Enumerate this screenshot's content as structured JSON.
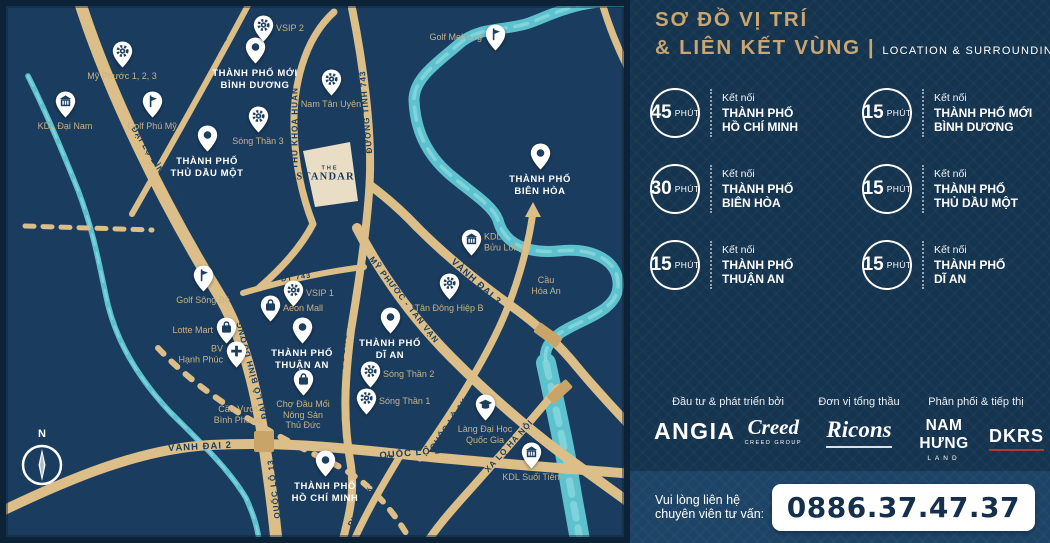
{
  "map": {
    "project": {
      "name_top": "THE",
      "name": "STANDARD"
    },
    "compass_label": "N",
    "cities": [
      {
        "label": "THÀNH PHỐ MỚI\nBÌNH DƯƠNG",
        "x": 255,
        "y": 64
      },
      {
        "label": "THÀNH PHỐ\nTHỦ DẦU MỘT",
        "x": 207,
        "y": 152
      },
      {
        "label": "THÀNH PHỐ\nBIÊN HÒA",
        "x": 540,
        "y": 170
      },
      {
        "label": "THÀNH PHỐ\nTHUẬN AN",
        "x": 302,
        "y": 344
      },
      {
        "label": "THÀNH PHỐ\nDĨ AN",
        "x": 390,
        "y": 334
      },
      {
        "label": "THÀNH PHỐ\nHỒ CHÍ MINH",
        "x": 325,
        "y": 477
      }
    ],
    "pois": [
      {
        "label": "Mỹ Phước 1, 2, 3",
        "icon": "gear",
        "x": 122,
        "y": 68,
        "pos": "below"
      },
      {
        "label": "VSIP 2",
        "icon": "gear",
        "x": 263,
        "y": 42,
        "pos": "right"
      },
      {
        "label": "KDL Đại Nam",
        "icon": "building",
        "x": 65,
        "y": 118,
        "pos": "below"
      },
      {
        "label": "Golf Phú Mỹ",
        "icon": "flag",
        "x": 152,
        "y": 118,
        "pos": "below"
      },
      {
        "label": "Sóng Thần 3",
        "icon": "gear",
        "x": 258,
        "y": 133,
        "pos": "below"
      },
      {
        "label": "Nam Tân Uyên",
        "icon": "gear",
        "x": 331,
        "y": 96,
        "pos": "below"
      },
      {
        "label": "Golf MeKong",
        "icon": "flag",
        "x": 495,
        "y": 51,
        "pos": "left"
      },
      {
        "label": "KDL\nBửu Long",
        "icon": "building",
        "x": 471,
        "y": 256,
        "pos": "right"
      },
      {
        "label": "Tân Đông Hiệp B",
        "icon": "gear",
        "x": 449,
        "y": 300,
        "pos": "below"
      },
      {
        "label": "Golf Sông Bé",
        "icon": "flag",
        "x": 203,
        "y": 292,
        "pos": "below"
      },
      {
        "label": "Lotte Mart",
        "icon": "bag",
        "x": 226,
        "y": 344,
        "pos": "left"
      },
      {
        "label": "BV\nHạnh Phúc",
        "icon": "cross",
        "x": 236,
        "y": 368,
        "pos": "left"
      },
      {
        "label": "VSIP 1",
        "icon": "gear",
        "x": 293,
        "y": 307,
        "pos": "right"
      },
      {
        "label": "Aeon Mall",
        "icon": "bag",
        "x": 270,
        "y": 322,
        "pos": "right"
      },
      {
        "label": "Chợ Đầu Mối\nNông Sản\nThủ Đức",
        "icon": "bag",
        "x": 303,
        "y": 396,
        "pos": "below"
      },
      {
        "label": "Sóng Thần 2",
        "icon": "gear",
        "x": 370,
        "y": 388,
        "pos": "right"
      },
      {
        "label": "Sóng Thần 1",
        "icon": "gear",
        "x": 366,
        "y": 415,
        "pos": "right"
      },
      {
        "label": "Làng Đại Học\nQuốc Gia",
        "icon": "grad",
        "x": 485,
        "y": 421,
        "pos": "below"
      },
      {
        "label": "KDL Suối Tiên",
        "icon": "building",
        "x": 531,
        "y": 469,
        "pos": "below"
      }
    ],
    "bridges": [
      {
        "label": "Cầu\nHóa An",
        "x": 546,
        "y": 286
      },
      {
        "label": "Cầu Vượt\nBình Phước",
        "x": 238,
        "y": 415
      }
    ],
    "road_labels": [
      {
        "text": "ĐẠI LỘ BÌNH DƯƠNG",
        "x": 160,
        "y": 170,
        "angle": 58
      },
      {
        "text": "ĐƯỜNG TỈNH 741",
        "x": 206,
        "y": 70,
        "angle": -60,
        "size": 7.5
      },
      {
        "text": "THỦ KHOA HUÂN",
        "x": 295,
        "y": 128,
        "angle": -90
      },
      {
        "text": "ĐƯỜNG TỈNH 743",
        "x": 366,
        "y": 112,
        "angle": -95
      },
      {
        "text": "ĐT 743",
        "x": 296,
        "y": 277,
        "angle": -8,
        "size": 7.5
      },
      {
        "text": "ĐƯỜNG TỈNH 743",
        "x": 345,
        "y": 328,
        "angle": -84
      },
      {
        "text": "ĐẠI LỘ BÌNH DƯƠNG",
        "x": 252,
        "y": 370,
        "angle": -105
      },
      {
        "text": "MỸ PHƯỚC - TÂN VẠN",
        "x": 404,
        "y": 300,
        "angle": 52
      },
      {
        "text": "VÀNH ĐAI 3",
        "x": 476,
        "y": 282,
        "angle": 42,
        "size": 9.5
      },
      {
        "text": "VÀNH ĐAI 2",
        "x": 200,
        "y": 447,
        "angle": -3,
        "size": 9.5
      },
      {
        "text": "QUỐC LỘ 13",
        "x": 274,
        "y": 489,
        "angle": -97
      },
      {
        "text": "QUỐC LỘ 1A",
        "x": 414,
        "y": 453,
        "angle": -5,
        "size": 9.5
      },
      {
        "text": "PHẠM VĂN ĐỒNG",
        "x": 371,
        "y": 490,
        "angle": -60
      },
      {
        "text": "QUỐC LỘ 1K",
        "x": 449,
        "y": 424,
        "angle": -56
      },
      {
        "text": "XA LỘ HÀ NỘI",
        "x": 509,
        "y": 446,
        "angle": -48
      }
    ]
  },
  "panel": {
    "title_line1": "SƠ ĐỒ VỊ TRÍ",
    "title_line2": "& LIÊN KẾT VÙNG",
    "title_divider": "|",
    "title_en": "LOCATION & SURROUNDINGS",
    "times": [
      {
        "value": "45",
        "unit": "PHÚT",
        "prefix": "Kết nối",
        "dest": "THÀNH PHỐ\nHỒ CHÍ MINH"
      },
      {
        "value": "15",
        "unit": "PHÚT",
        "prefix": "Kết nối",
        "dest": "THÀNH PHỐ MỚI\nBÌNH DƯƠNG"
      },
      {
        "value": "30",
        "unit": "PHÚT",
        "prefix": "Kết nối",
        "dest": "THÀNH PHỐ\nBIÊN HÒA"
      },
      {
        "value": "15",
        "unit": "PHÚT",
        "prefix": "Kết nối",
        "dest": "THÀNH PHỐ\nTHỦ DẦU MỘT"
      },
      {
        "value": "15",
        "unit": "PHÚT",
        "prefix": "Kết nối",
        "dest": "THÀNH PHỐ\nTHUẬN AN"
      },
      {
        "value": "15",
        "unit": "PHÚT",
        "prefix": "Kết nối",
        "dest": "THÀNH PHỐ\nDĨ AN"
      }
    ],
    "partners": {
      "developer": {
        "heading": "Đầu tư & phát triển bởi",
        "angia": "ANGIA",
        "creed": "Creed",
        "creed_sub": "CREED GROUP"
      },
      "contractor": {
        "heading": "Đơn vị tổng thầu",
        "logo": "Ricons"
      },
      "distributor": {
        "heading": "Phân phối & tiếp thị",
        "namhung": "NAM HƯNG",
        "namhung_sub": "LAND",
        "dkrs": "DKRS"
      }
    },
    "contact": {
      "label": "Vui lòng liên hệ chuyên viên tư vấn:",
      "phone": "0886.37.47.37"
    }
  },
  "colors": {
    "map_background": "#1A3C5E",
    "panel_background": "#15344F",
    "contact_strip": "#1D4466",
    "road": "#DCBE88",
    "bridge": "#C8A468",
    "river": "#5EC2CE",
    "title_gold": "#C9A672",
    "poi_label_gold": "#C9B287",
    "road_label_navy": "#1C3F60",
    "phone_text_navy": "#14304C",
    "dkrs_red": "#B03A30",
    "white": "#FFFFFF"
  }
}
